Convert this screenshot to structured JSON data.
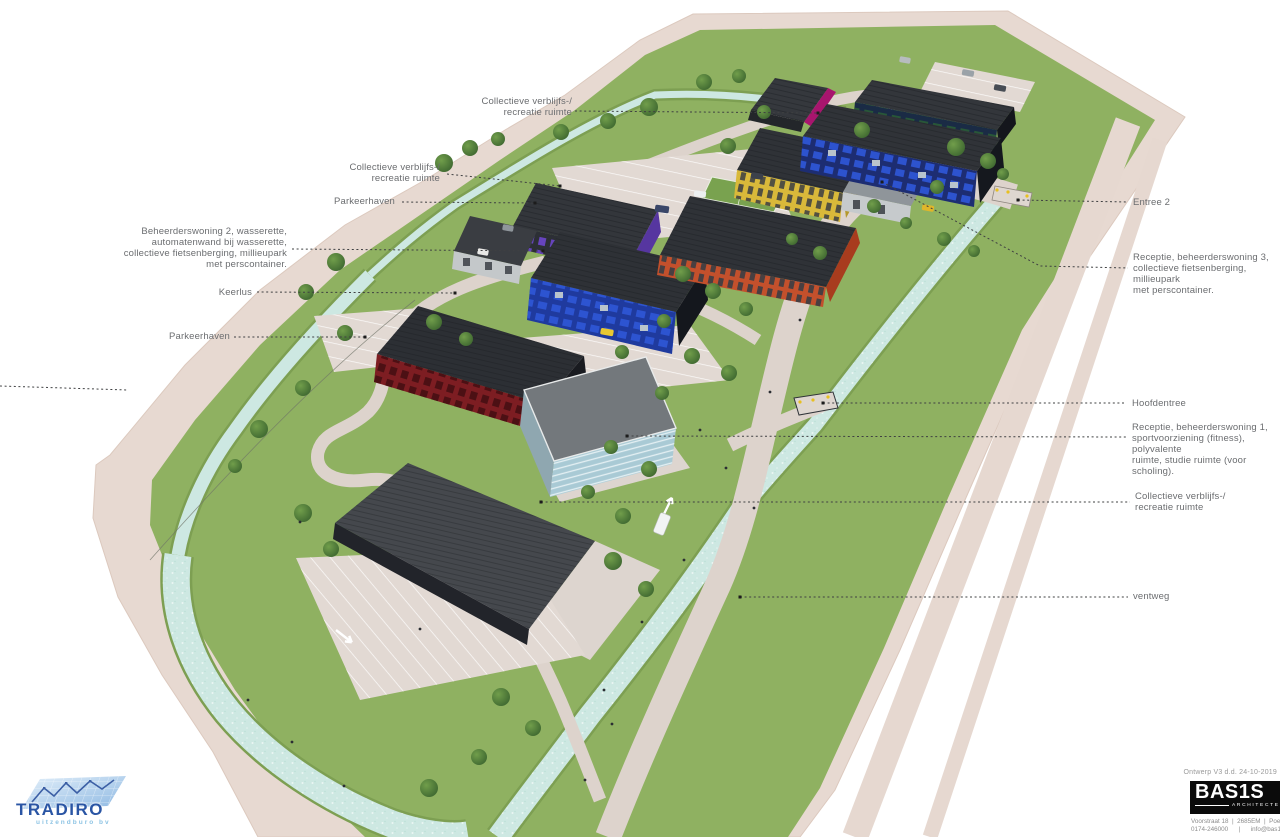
{
  "annotations": {
    "left": [
      {
        "label": "Collectieve verblijfs-/\nrecreatie ruimte"
      },
      {
        "label": "Collectieve verblijfs-/\nrecreatie ruimte"
      },
      {
        "label": "Parkeerhaven"
      },
      {
        "label": "Beheerderswoning 2, wasserette,\nautomatenwand bij wasserette,\ncollectieve fietsenberging, millieupark\nmet perscontainer."
      },
      {
        "label": "Keerlus"
      },
      {
        "label": "Parkeerhaven"
      }
    ],
    "right": [
      {
        "label": "Entree 2"
      },
      {
        "label": "Receptie, beheerderswoning 3,\ncollectieve fietsenberging, millieupark\nmet perscontainer."
      },
      {
        "label": "Hoofdentree"
      },
      {
        "label": "Receptie, beheerderswoning 1,\nsportvoorziening (fitness), polyvalente\nruimte, studie ruimte (voor scholing)."
      },
      {
        "label": "Collectieve verblijfs-/\nrecreatie ruimte"
      },
      {
        "label": "ventweg"
      }
    ]
  },
  "branding": {
    "client": {
      "name": "TRADIRO",
      "subtitle": "uitzendburo bv"
    },
    "architect": {
      "name": "BAS1S",
      "subtitle": "ARCHITECTEN",
      "address": "Voorstraat 18  |  2685EM  |  Poeld\n0174-246000      |      info@bas1s"
    }
  },
  "title_block": {
    "version_note": "Ontwerp V3 d.d. 24-10-2019"
  },
  "colors": {
    "grass": "#8FB161",
    "path_pink": "#E7D9D1",
    "water": "#CDE8E2",
    "label_text": "#6B6D70",
    "building_magenta": "#A8156E",
    "building_navy": "#1D2D72",
    "building_window_blue": "#2E55D4",
    "building_yellow": "#D9B93A",
    "building_purple": "#5636A0",
    "building_orange": "#C3502C",
    "building_red": "#7D1D22",
    "building_glass": "#A9CAD5"
  }
}
